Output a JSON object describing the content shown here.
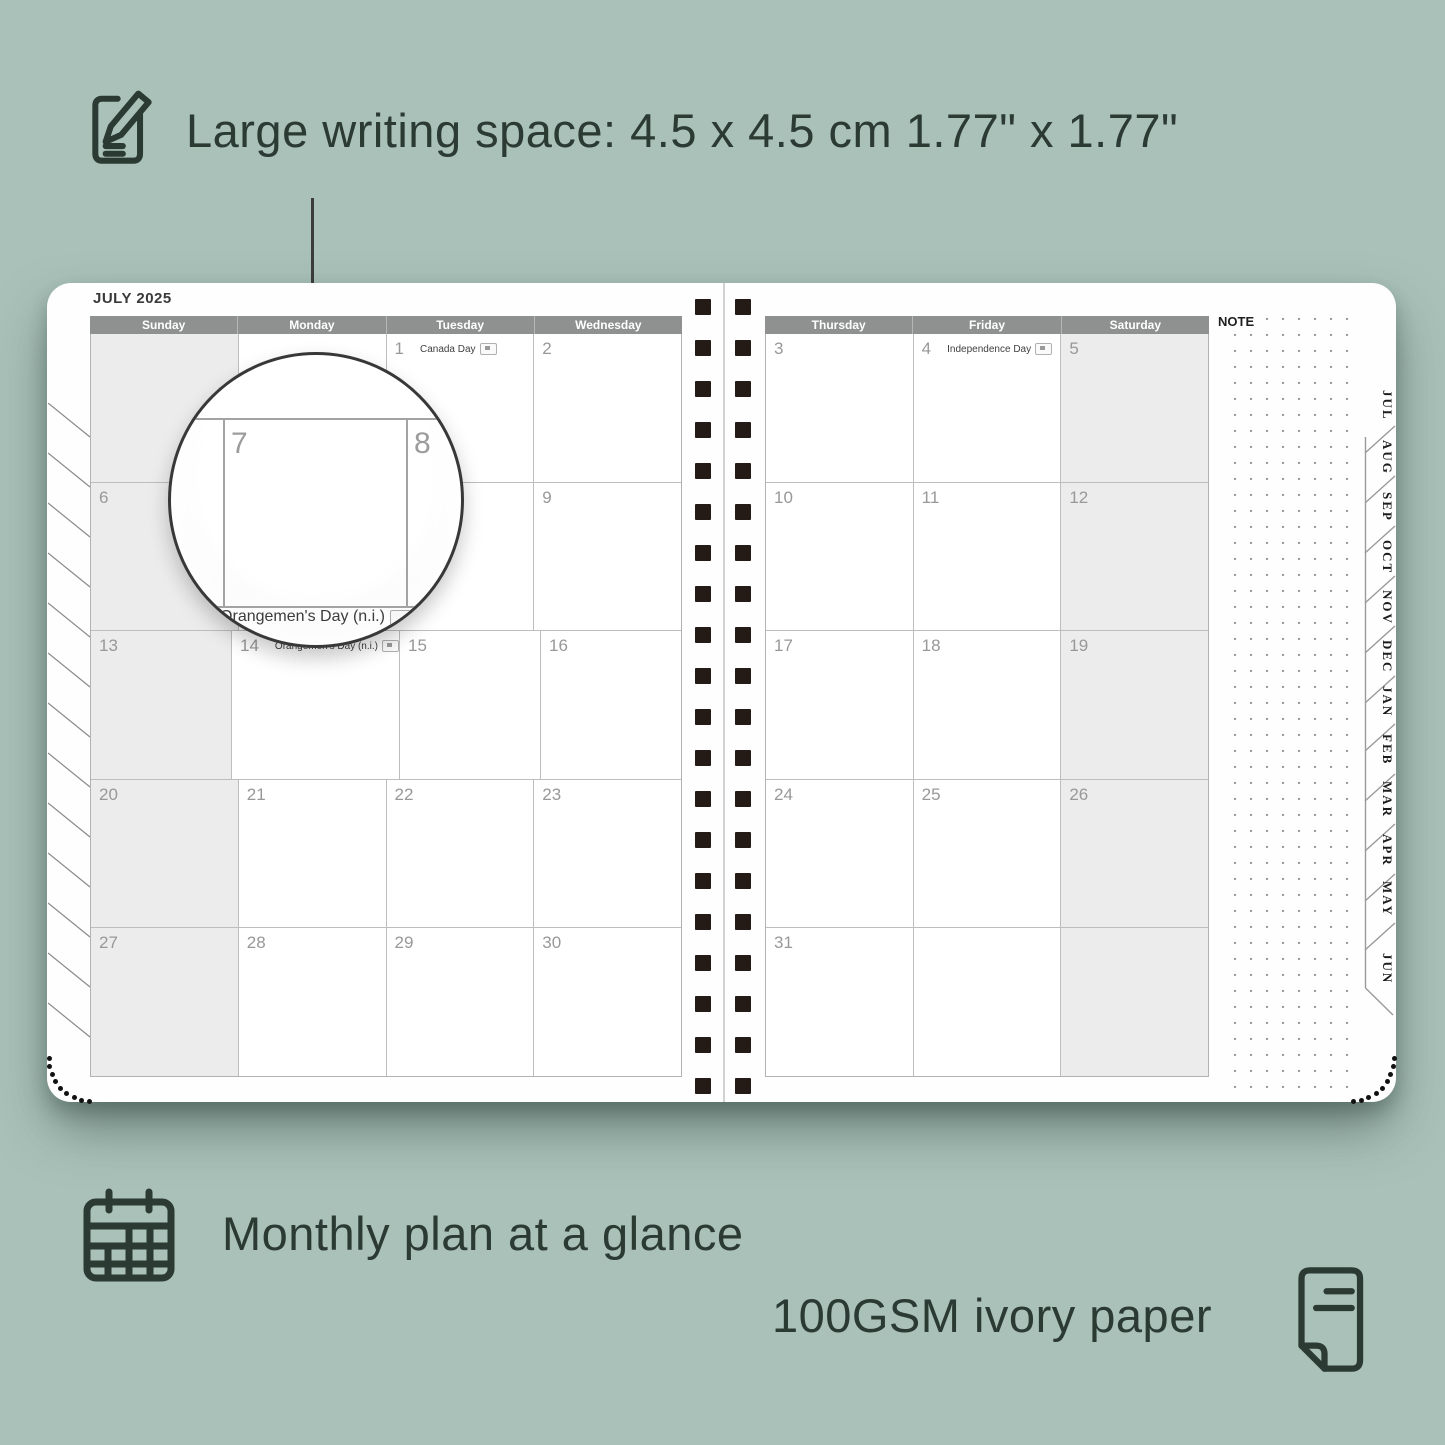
{
  "colors": {
    "background": "#a9c1b9",
    "ink": "#2c3a34",
    "header_bar": "#8f9090",
    "weekend_fill": "#ececec",
    "binding": "#241b16"
  },
  "annotations": {
    "writing_space": "Large writing space: 4.5 x 4.5 cm  1.77\" x 1.77\"",
    "monthly_plan": "Monthly plan at a glance",
    "paper": "100GSM ivory paper"
  },
  "planner": {
    "title": "JULY 2025",
    "note_label": "NOTE",
    "month_tabs": [
      "JUL",
      "AUG",
      "SEP",
      "OCT",
      "NOV",
      "DEC",
      "JAN",
      "FEB",
      "MAR",
      "APR",
      "MAY",
      "JUN"
    ],
    "left_page": {
      "headers": [
        "Sunday",
        "Monday",
        "Tuesday",
        "Wednesday"
      ],
      "rows": [
        [
          {
            "day": "",
            "shaded": true
          },
          {
            "day": ""
          },
          {
            "day": "1",
            "holiday": "Canada Day"
          },
          {
            "day": "2"
          }
        ],
        [
          {
            "day": "6",
            "shaded": true
          },
          {
            "day": "7"
          },
          {
            "day": "8"
          },
          {
            "day": "9"
          }
        ],
        [
          {
            "day": "13",
            "shaded": true
          },
          {
            "day": "14",
            "holiday": "Orangemen's Day (n.i.)"
          },
          {
            "day": "15"
          },
          {
            "day": "16"
          }
        ],
        [
          {
            "day": "20",
            "shaded": true
          },
          {
            "day": "21"
          },
          {
            "day": "22"
          },
          {
            "day": "23"
          }
        ],
        [
          {
            "day": "27",
            "shaded": true
          },
          {
            "day": "28"
          },
          {
            "day": "29"
          },
          {
            "day": "30"
          }
        ]
      ]
    },
    "right_page": {
      "headers": [
        "Thursday",
        "Friday",
        "Saturday"
      ],
      "rows": [
        [
          {
            "day": "3"
          },
          {
            "day": "4",
            "holiday": "Independence Day"
          },
          {
            "day": "5",
            "shaded": true
          }
        ],
        [
          {
            "day": "10"
          },
          {
            "day": "11"
          },
          {
            "day": "12",
            "shaded": true
          }
        ],
        [
          {
            "day": "17"
          },
          {
            "day": "18"
          },
          {
            "day": "19",
            "shaded": true
          }
        ],
        [
          {
            "day": "24"
          },
          {
            "day": "25"
          },
          {
            "day": "26",
            "shaded": true
          }
        ],
        [
          {
            "day": "31"
          },
          {
            "day": ""
          },
          {
            "day": "",
            "shaded": true
          }
        ]
      ]
    },
    "magnifier": {
      "day_left": "7",
      "day_right": "8",
      "holiday": "Orangemen's Day (n.i.)"
    }
  }
}
